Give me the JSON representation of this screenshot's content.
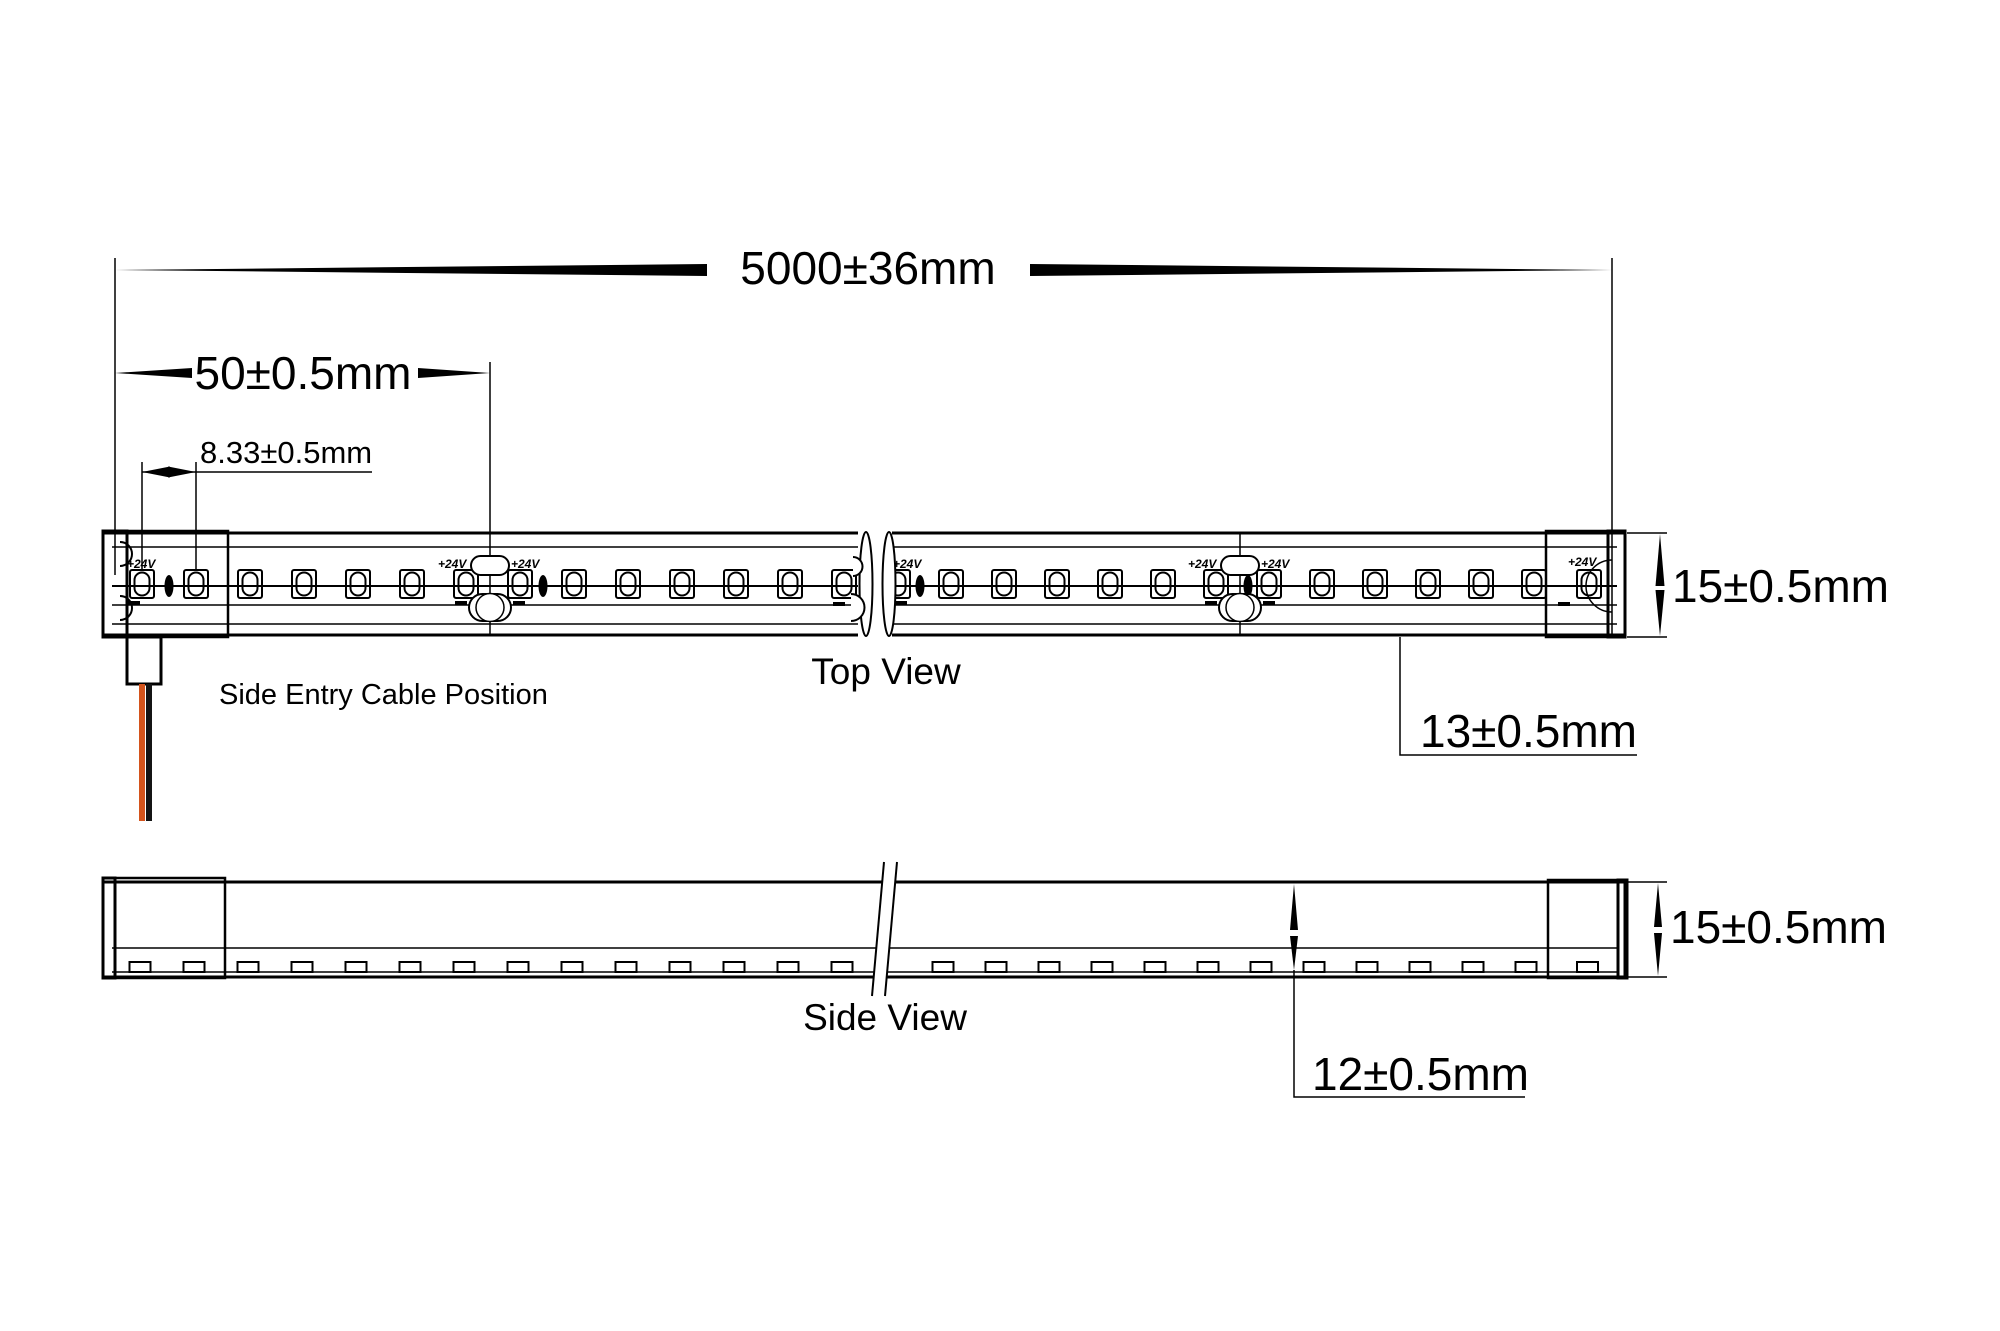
{
  "figure": {
    "type": "technical-drawing",
    "subject": "LED neon flex strip - dimension drawing",
    "views": {
      "top": "Top View",
      "side": "Side View"
    },
    "annotations": {
      "cable": "Side Entry Cable Position",
      "voltage": "+24V"
    },
    "dimensions": {
      "overall_length": "5000±36mm",
      "cut_increment": "50±0.5mm",
      "led_pitch": "8.33±0.5mm",
      "strip_width_top": "15±0.5mm",
      "pcb_width": "13±0.5mm",
      "strip_height_side": "15±0.5mm",
      "body_height": "12±0.5mm"
    },
    "colors": {
      "line": "#000000",
      "background": "#ffffff",
      "wire_positive": "#d4541c",
      "wire_negative": "#141414"
    }
  }
}
